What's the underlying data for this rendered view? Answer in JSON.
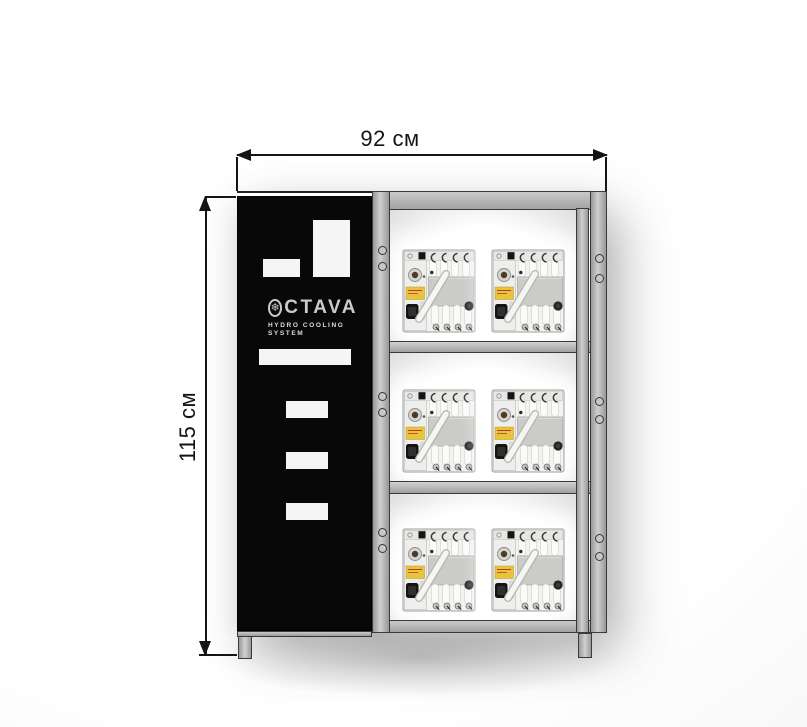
{
  "dimensions": {
    "width_label": "92 см",
    "height_label": "115 см"
  },
  "cabinet": {
    "brand_icon": "snowflake-in-circle",
    "brand_icon_char": "❄",
    "brand_text": "CTAVA",
    "subtitle_line1": "HYDRO COOLING",
    "subtitle_line2": "SYSTEM"
  },
  "rack": {
    "rows": 3,
    "columns": 2,
    "machines": [
      {
        "row": 1,
        "col": 1
      },
      {
        "row": 1,
        "col": 2
      },
      {
        "row": 2,
        "col": 1
      },
      {
        "row": 2,
        "col": 2
      },
      {
        "row": 3,
        "col": 1
      },
      {
        "row": 3,
        "col": 2
      }
    ]
  },
  "colors": {
    "dimension_line": "#141414",
    "door_black": "#080808",
    "door_cutout": "#f5f5f5",
    "frame_gray": "#b5b5b5",
    "frame_border": "#3a3a3a",
    "logo_gray": "#cbcbcb",
    "label_yellow": "#e7c43d"
  }
}
